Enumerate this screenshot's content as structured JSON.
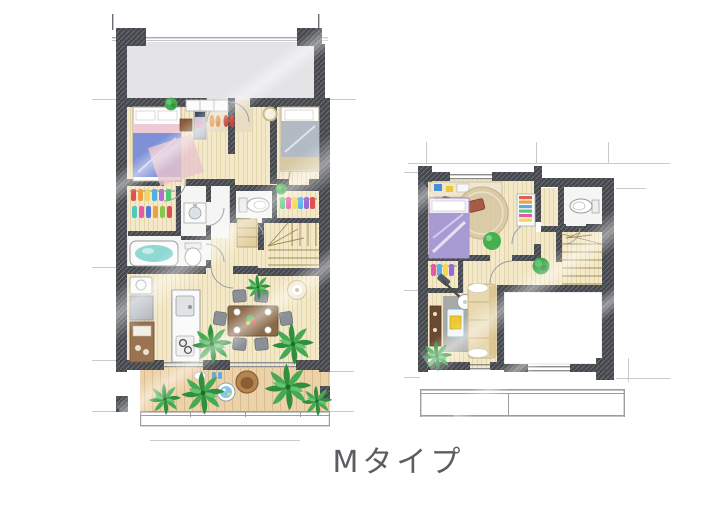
{
  "title": {
    "label": "Mタイプ"
  },
  "palette": {
    "wall": "#45484d",
    "floor": "#f3e9c9",
    "terrace": "#e4e4e7",
    "deck": "#ecd2a9",
    "white_room": "#f5f5f3",
    "tub": "#8fd8d4",
    "bed_blue": "#7f91d6",
    "bed_pink": "#eec9d6",
    "bed_gray": "#b2bac4",
    "bed_purple": "#a89bd4",
    "rug_round": "#d8c8a2",
    "sofa": "#e8d8b0",
    "table_wood": "#8a6a4a",
    "chair": "#8b9097",
    "cabinet": "#9a7352",
    "lamp": "#efe8d5",
    "plant_dark": "#2f8f3e",
    "plant_mid": "#45aa52",
    "plant_light": "#63c56f",
    "water": "#7ec8e8",
    "guide": "#c9c9ce",
    "text": "#5c5d60"
  }
}
